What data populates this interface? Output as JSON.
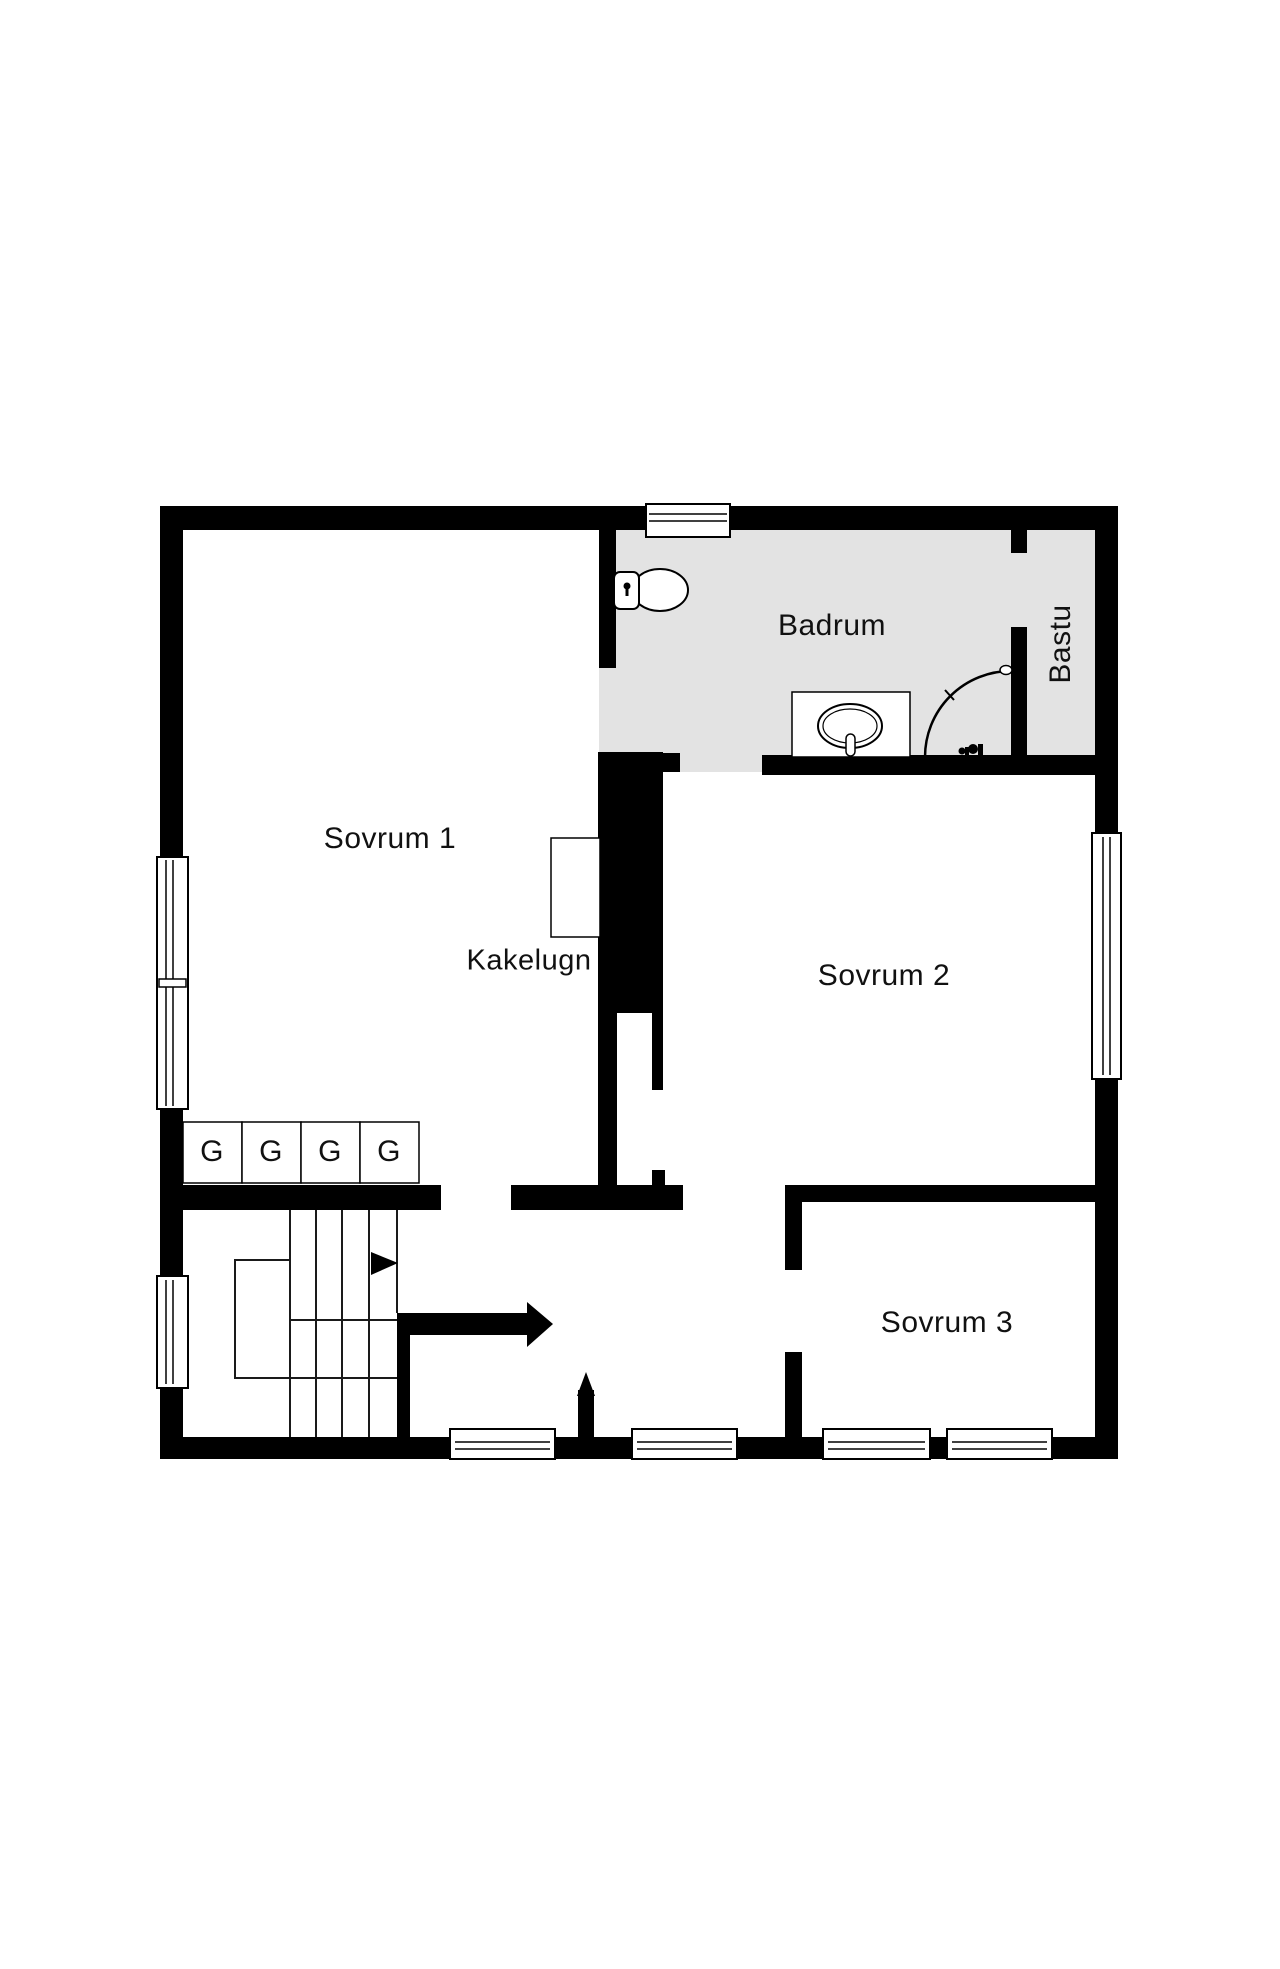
{
  "document": {
    "type": "floor-plan",
    "language": "sv"
  },
  "colors": {
    "wall": "#000000",
    "badrum_floor": "#e3e3e3",
    "background": "#ffffff",
    "text": "#111111"
  },
  "rooms": {
    "sovrum1": {
      "label": "Sovrum 1"
    },
    "sovrum2": {
      "label": "Sovrum 2"
    },
    "sovrum3": {
      "label": "Sovrum 3"
    },
    "badrum": {
      "label": "Badrum"
    },
    "bastu": {
      "label": "Bastu"
    },
    "kakelugn": {
      "label": "Kakelugn"
    }
  },
  "closets": {
    "items": [
      {
        "label": "G"
      },
      {
        "label": "G"
      },
      {
        "label": "G"
      },
      {
        "label": "G"
      }
    ]
  },
  "fixtures": {
    "toilet": "toilet-icon",
    "sink": "sink-icon",
    "shower": "shower-curtain-arc-icon",
    "mixer": "shower-mixer-icon",
    "stairs": "staircase-icon",
    "stair_direction": "stair-direction-arrow-icon",
    "hall_door": "door-direction-arrow-icon",
    "entry_door": "door-direction-arrow-icon",
    "windows_count": "8"
  }
}
